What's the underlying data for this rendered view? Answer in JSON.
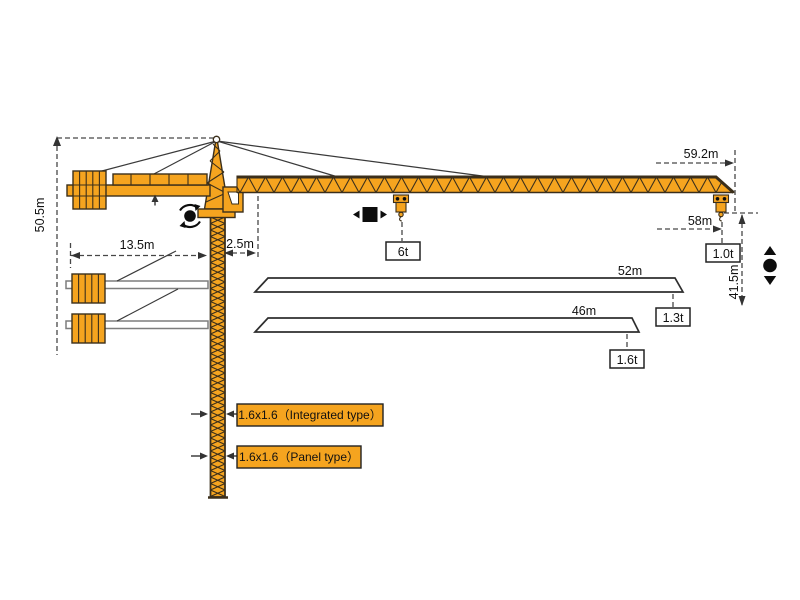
{
  "colors": {
    "crane": "#F5A41F",
    "outline": "#3B2F1B",
    "dim": "#474747"
  },
  "dims": {
    "total_height": "50.5m",
    "counter_jib_radius": "13.5m",
    "tail_offset": "2.5m",
    "max_radius": "59.2m",
    "hook_radius": "58m",
    "hook_height": "41.5m"
  },
  "main_jib": {
    "load_mid": "6t",
    "load_tip": "1.0t"
  },
  "jib_variants": [
    {
      "length": "52m",
      "tip_load": "1.3t"
    },
    {
      "length": "46m",
      "tip_load": "1.6t"
    }
  ],
  "mast_types": [
    {
      "label": "1.6x1.6（Integrated type）"
    },
    {
      "label": "1.6x1.6（Panel type）"
    }
  ],
  "icons": {
    "slewing": "⟳",
    "trolley_travel": "◀■▶",
    "hoisting": "▲●▼"
  }
}
